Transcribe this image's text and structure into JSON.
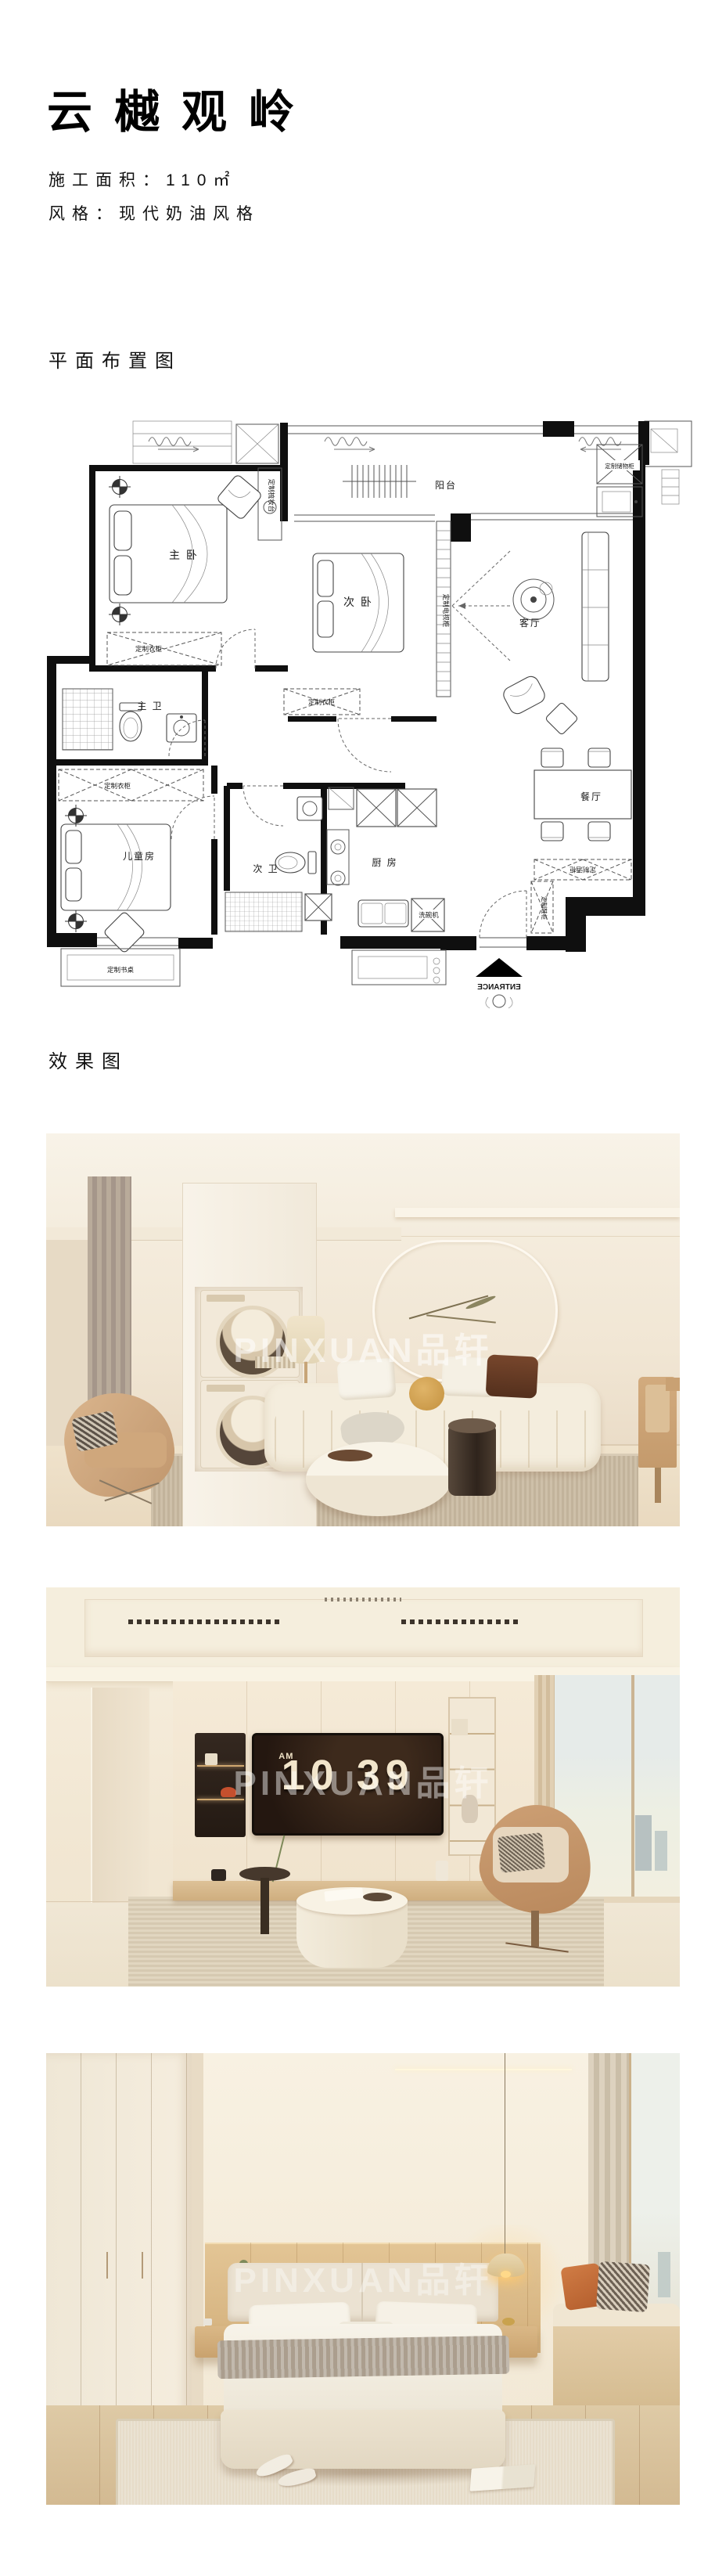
{
  "header": {
    "title": "云樾观岭",
    "area": "施工面积：110㎡",
    "style": "风格：现代奶油风格"
  },
  "sections": {
    "floorplan": "平面布置图",
    "renders": "效果图"
  },
  "floorplan": {
    "rooms": {
      "master_bedroom": "主 卧",
      "second_bedroom": "次 卧",
      "kids_room": "儿童房",
      "master_bath": "主 卫",
      "second_bath": "次 卫",
      "kitchen": "厨 房",
      "dining_room": "餐厅",
      "living_room": "客厅",
      "balcony": "阳台"
    },
    "labels": {
      "wardrobe_master": "定制衣柜",
      "wardrobe_kids": "定制衣柜",
      "wardrobe_second": "定制衣柜",
      "dresser": "定制梳妆台",
      "tv_cabinet": "定制电视柜",
      "storage_cabinet": "定制储物柜",
      "desk": "定制书桌",
      "wine_cabinet": "定制酒柜",
      "shoe_cabinet": "定制鞋柜",
      "dishwasher": "洗碗机",
      "entrance": "ENTRANCE"
    }
  },
  "renders": {
    "watermark": "PINXUAN品轩",
    "clock_meridiem": "AM",
    "clock_time": "10 39"
  }
}
